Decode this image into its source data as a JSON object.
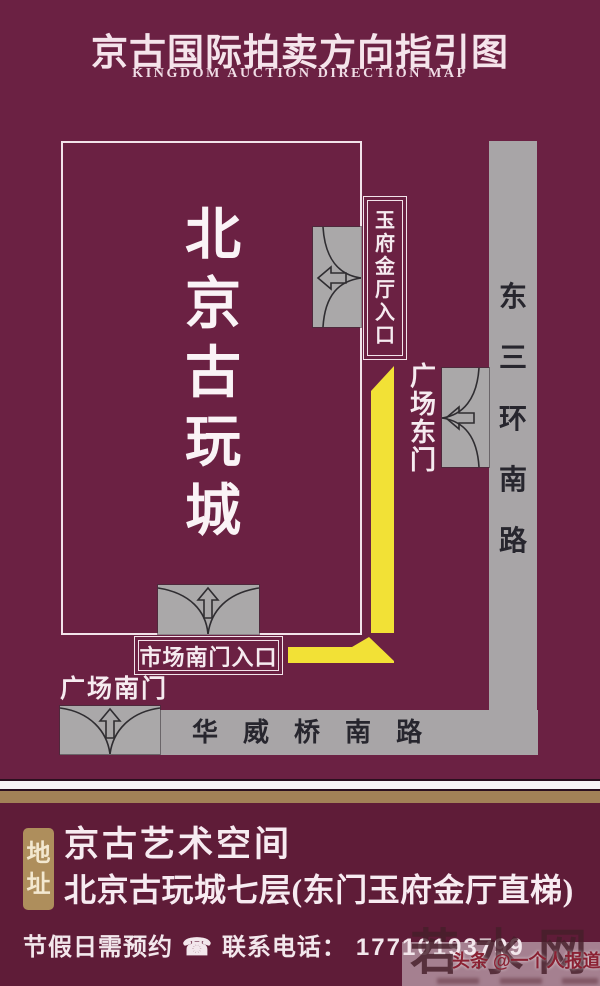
{
  "title": {
    "cn": "京古国际拍卖方向指引图",
    "en": "KINGDOM AUCTION DIRECTION MAP"
  },
  "map": {
    "building_chars": [
      "北",
      "京",
      "古",
      "玩",
      "城"
    ],
    "jade_hall_entrance_chars": [
      "玉",
      "府",
      "金",
      "厅",
      "入",
      "口"
    ],
    "plaza_east_gate_chars": [
      "广",
      "场",
      "东",
      "门"
    ],
    "market_south_entrance_label": "市场南门入口",
    "plaza_south_gate_label": "广场南门",
    "east_road_chars": [
      "东",
      "三",
      "环",
      "南",
      "路"
    ],
    "south_road_chars": [
      "华",
      "威",
      "桥",
      "南",
      "路"
    ]
  },
  "footer": {
    "address_badge_chars": [
      "地",
      "址"
    ],
    "line1": "京古艺术空间",
    "line2": "北京古玩城七层(东门玉府金厅直梯)",
    "notice": "节假日需预约",
    "phone_icon": "☎",
    "phone_label": "联系电话：",
    "phone_number": "17710193799"
  },
  "watermark": {
    "site_chars": [
      "若",
      "水",
      "网"
    ],
    "credit": "头条 @一个人报道"
  },
  "colors": {
    "background": "#6b2143",
    "footer_background": "#5f1c38",
    "route_yellow": "#f2e136",
    "road_gray": "#a8a5a7",
    "accent_tan": "#a28157",
    "badge_gold": "#ae8e5c",
    "text_light": "#f7ebf1",
    "road_text_dark": "#27262e"
  }
}
